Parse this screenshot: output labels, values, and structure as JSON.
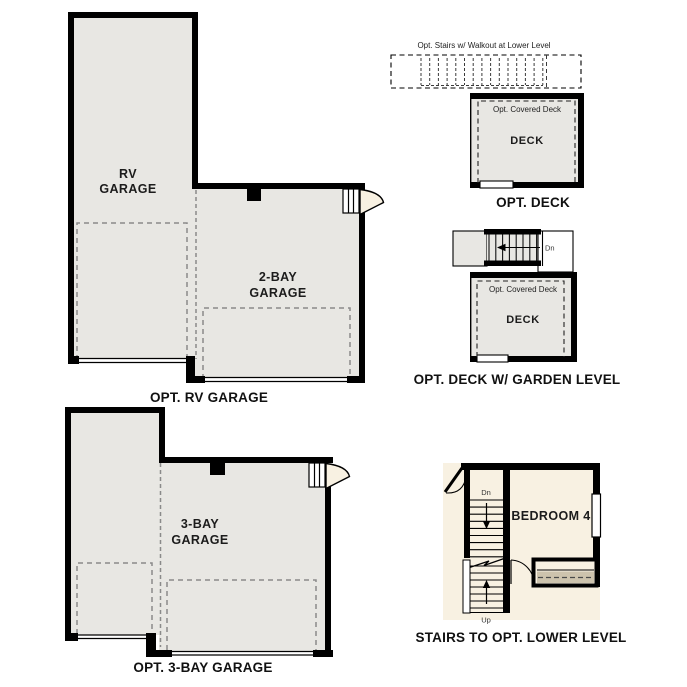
{
  "colors": {
    "floor_gray": "#e8e7e3",
    "cream": "#f8f1e2",
    "closet_tan": "#cdc3ad",
    "wall_black": "#000000",
    "dash_gray": "#8a8a8a"
  },
  "plans": {
    "rv_garage": {
      "caption": "OPT. RV GARAGE",
      "rooms": {
        "rv": {
          "line1": "RV",
          "line2": "GARAGE"
        },
        "two_bay": {
          "line1": "2-BAY",
          "line2": "GARAGE"
        }
      }
    },
    "deck": {
      "caption": "OPT. DECK",
      "stairs_note": "Opt. Stairs w/ Walkout at Lower Level",
      "covered_note": "Opt. Covered Deck",
      "room": "DECK"
    },
    "deck_garden": {
      "caption": "OPT. DECK W/ GARDEN LEVEL",
      "covered_note": "Opt. Covered Deck",
      "room": "DECK",
      "dn": "Dn"
    },
    "three_bay": {
      "caption": "OPT. 3-BAY GARAGE",
      "room": {
        "line1": "3-BAY",
        "line2": "GARAGE"
      }
    },
    "stairs_lower": {
      "caption": "STAIRS TO OPT. LOWER LEVEL",
      "room": "BEDROOM 4",
      "dn": "Dn",
      "up": "Up"
    }
  }
}
